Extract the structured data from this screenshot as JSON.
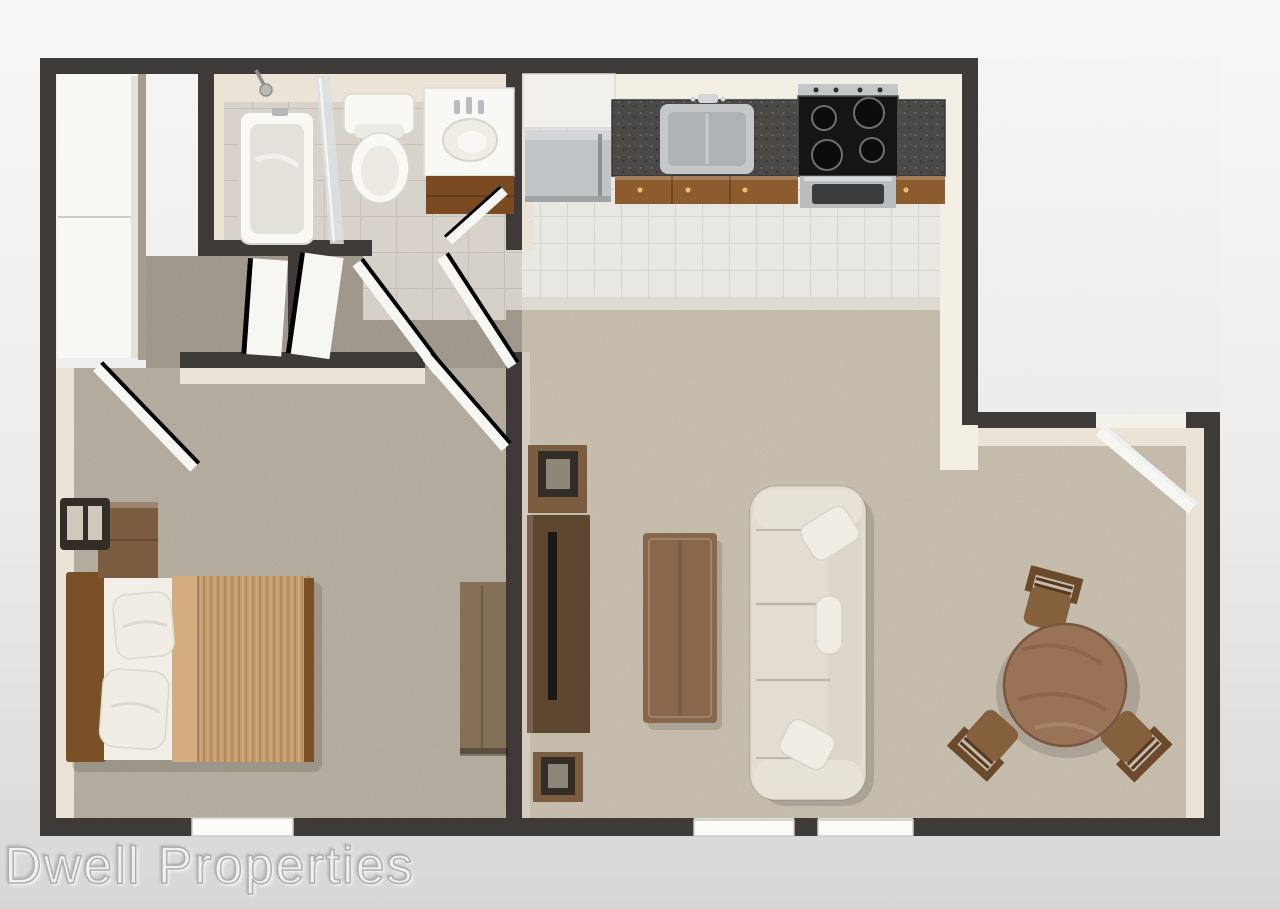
{
  "watermark": {
    "text": "Dwell Properties"
  },
  "palette": {
    "bg-top": "#f7f7f7",
    "bg-mid": "#ececec",
    "bg-bottom": "#d7d7d7",
    "wall": "#3d3a37",
    "wall-face": "#ebe4d6",
    "wall-face-bright": "#f4efe4",
    "tile-bath": "#d8d3cb",
    "tile-bath-grout": "#c6c0b5",
    "tile-kitchen": "#eae8e3",
    "tile-kitchen-grout": "#d5d1ca",
    "carpet-living": "#c6bcab",
    "carpet-bed": "#b3aa9c",
    "carpet-hall": "#9e9588",
    "counter": "#4b4947",
    "cabinet": "#8c5c2e",
    "steel": "#c4c8ca",
    "fridge": "#c0c4c6",
    "white-fixture": "#f8f8f5",
    "glass": "#dce0e1",
    "sofa": "#e2ddd0",
    "sofa-shadow": "#beb8a9",
    "pillow": "#f0ede4",
    "wood-dark": "#5e4731",
    "wood-mid": "#7b5c3e",
    "wood-coffee": "#8a674a",
    "wood-table": "#9a7356",
    "wood-bed": "#7a5126",
    "wood-chair": "#85603c",
    "wood-dresser": "#847057",
    "comforter": "#c49c6c",
    "comforter-fold": "#d4ad7e",
    "sheet": "#f0eee7",
    "lamp-dark": "#332d27",
    "lamp-pane": "#cfcabc",
    "door-white": "#f6f6f3",
    "door-edge": "#fdfdfd",
    "watermark": "#f2f2f2"
  },
  "scene": {
    "description": "3D top-down floor plan rendering of a one-bedroom apartment",
    "rooms": [
      {
        "name": "Bathroom",
        "items": [
          "bathtub",
          "shower-head",
          "glass-shower-panel",
          "toilet",
          "vanity-with-sink"
        ]
      },
      {
        "name": "Kitchen",
        "items": [
          "refrigerator",
          "white-cabinet",
          "granite-countertop",
          "kitchen-sink",
          "stove-cooktop",
          "oven",
          "wood-cabinets",
          "tile-floor"
        ]
      },
      {
        "name": "Hallway",
        "items": [
          "sliding-door-closet",
          "linen-closet-doors",
          "open-interior-doors"
        ]
      },
      {
        "name": "Bedroom",
        "items": [
          "bed-with-headboard",
          "pillows",
          "tan-comforter",
          "nightstand",
          "cube-lamp",
          "dresser",
          "window"
        ]
      },
      {
        "name": "Living Room",
        "items": [
          "sofa",
          "throw-pillows",
          "coffee-table",
          "tv-console",
          "television",
          "side-table-with-lamp-north",
          "side-table-with-lamp-south",
          "patio-window"
        ]
      },
      {
        "name": "Dining Area",
        "items": [
          "round-dining-table",
          "dining-chair",
          "dining-chair",
          "dining-chair",
          "open-entry-door"
        ]
      }
    ]
  }
}
